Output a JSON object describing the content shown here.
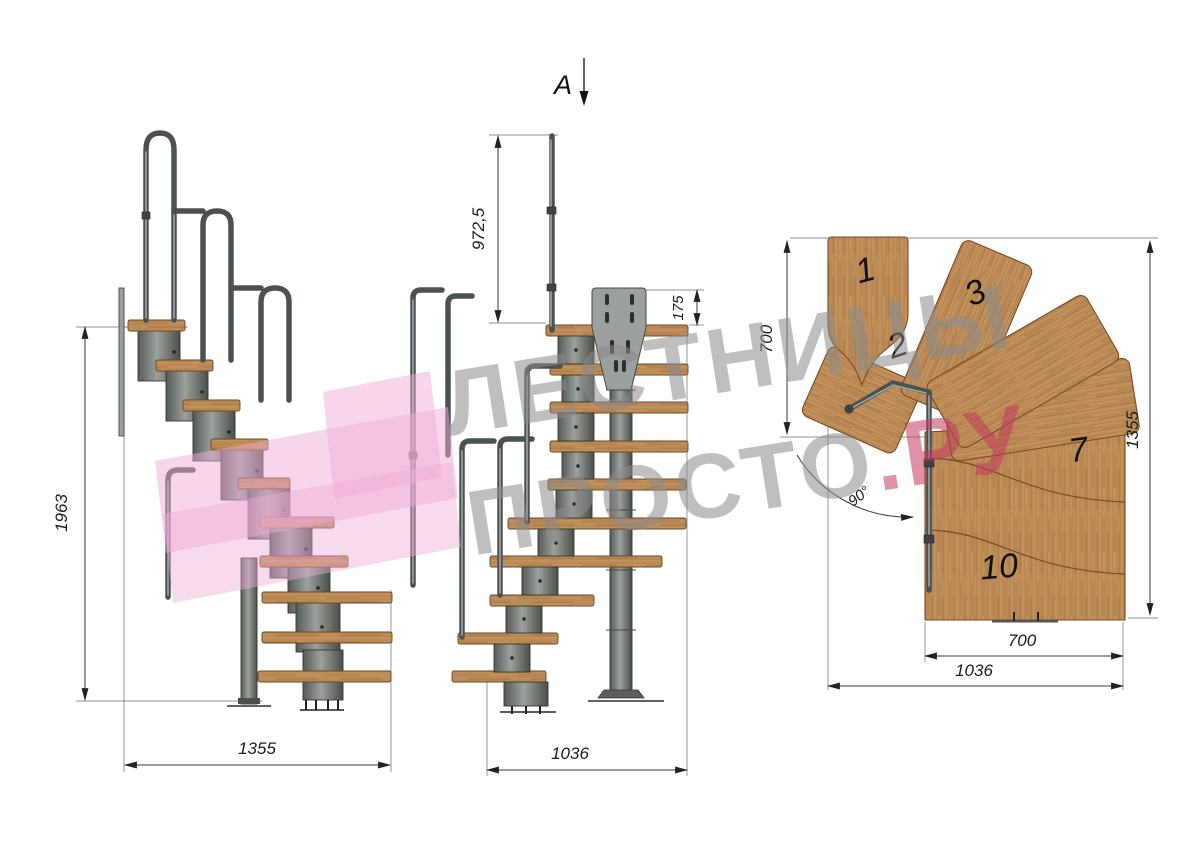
{
  "drawing": {
    "watermark": {
      "line1": "ЛЕСТНИЦЫ",
      "line2_gray": "ПРОСТО",
      "line2_red": ".РУ"
    },
    "side_view": {
      "height": "1963",
      "width": "1355"
    },
    "front_view": {
      "section_label": "A",
      "handrail_height": "972,5",
      "bracket_height": "175",
      "width": "1036"
    },
    "plan_view": {
      "entry_depth": "700",
      "length": "1355",
      "flight_width": "700",
      "total_width": "1036",
      "turn_angle": "90°",
      "tread_numbers": [
        "1",
        "2",
        "3",
        "7",
        "10"
      ]
    }
  },
  "colors": {
    "wood": "#c1905c",
    "wood_shade": "#9a6a38",
    "metal": "#7c817d",
    "rail": "#4b5052",
    "dimension": "#2a2a2a",
    "watermark_gray": "#8c8c8c",
    "watermark_red": "#c23a5e",
    "pink_logo": "#f0aed8"
  }
}
